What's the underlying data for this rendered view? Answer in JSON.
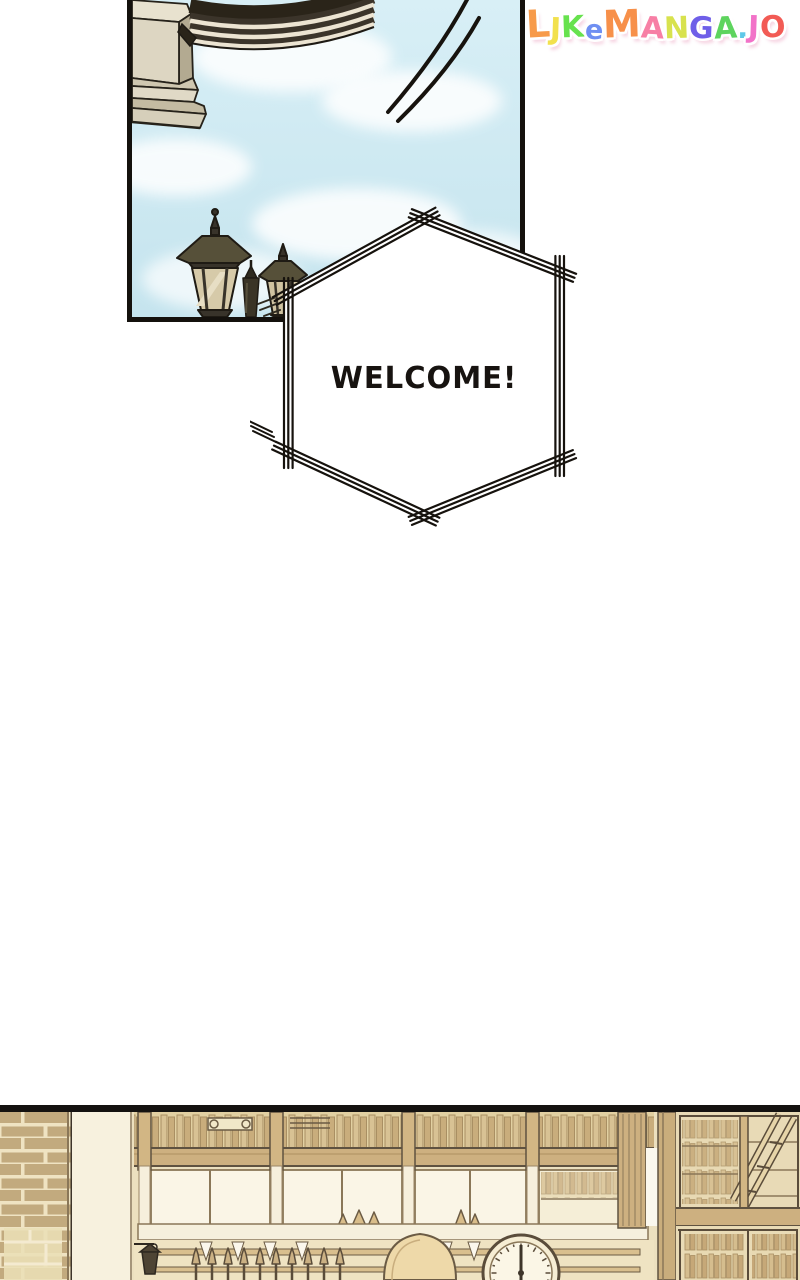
{
  "watermark": {
    "text": "LJKeMANGA.JO",
    "letters": [
      {
        "ch": "L",
        "color": "#F79A4A"
      },
      {
        "ch": "J",
        "color": "#F2E14E"
      },
      {
        "ch": "K",
        "color": "#67E24E"
      },
      {
        "ch": "e",
        "color": "#6F8FF2"
      },
      {
        "ch": "M",
        "color": "#F7904A"
      },
      {
        "ch": "A",
        "color": "#F77FA5"
      },
      {
        "ch": "N",
        "color": "#D8E24E"
      },
      {
        "ch": "G",
        "color": "#6F5FE8"
      },
      {
        "ch": "A",
        "color": "#5ED45E"
      },
      {
        "ch": ".",
        "color": "#5FC8E8"
      },
      {
        "ch": "J",
        "color": "#F272C8"
      },
      {
        "ch": "O",
        "color": "#F25B55"
      }
    ]
  },
  "speech_bubble": {
    "text": "WELCOME!"
  },
  "colors": {
    "page_bg": "#ffffff",
    "ink": "#16120d",
    "sky_top": "#d8eff6",
    "sky_bottom": "#c5e4ee",
    "building_light": "#ddd6c2",
    "building_mid": "#cfc7b0",
    "building_dark": "#b3aa91",
    "arch_dark": "#3b342a",
    "arch_light": "#ece4d2",
    "lamp_metal": "#565039",
    "lamp_metal_dark": "#38332a",
    "lamp_glass": "#d6caa9",
    "sepia_wall": "#ece0bf",
    "sepia_frame": "#cdb080",
    "sepia_pane": "#faf5e6",
    "sepia_cream": "#f6f0dd",
    "sepia_ink": "#5f5240",
    "brick": "#c2aa7e",
    "brick_mortar": "#efe3c2"
  }
}
